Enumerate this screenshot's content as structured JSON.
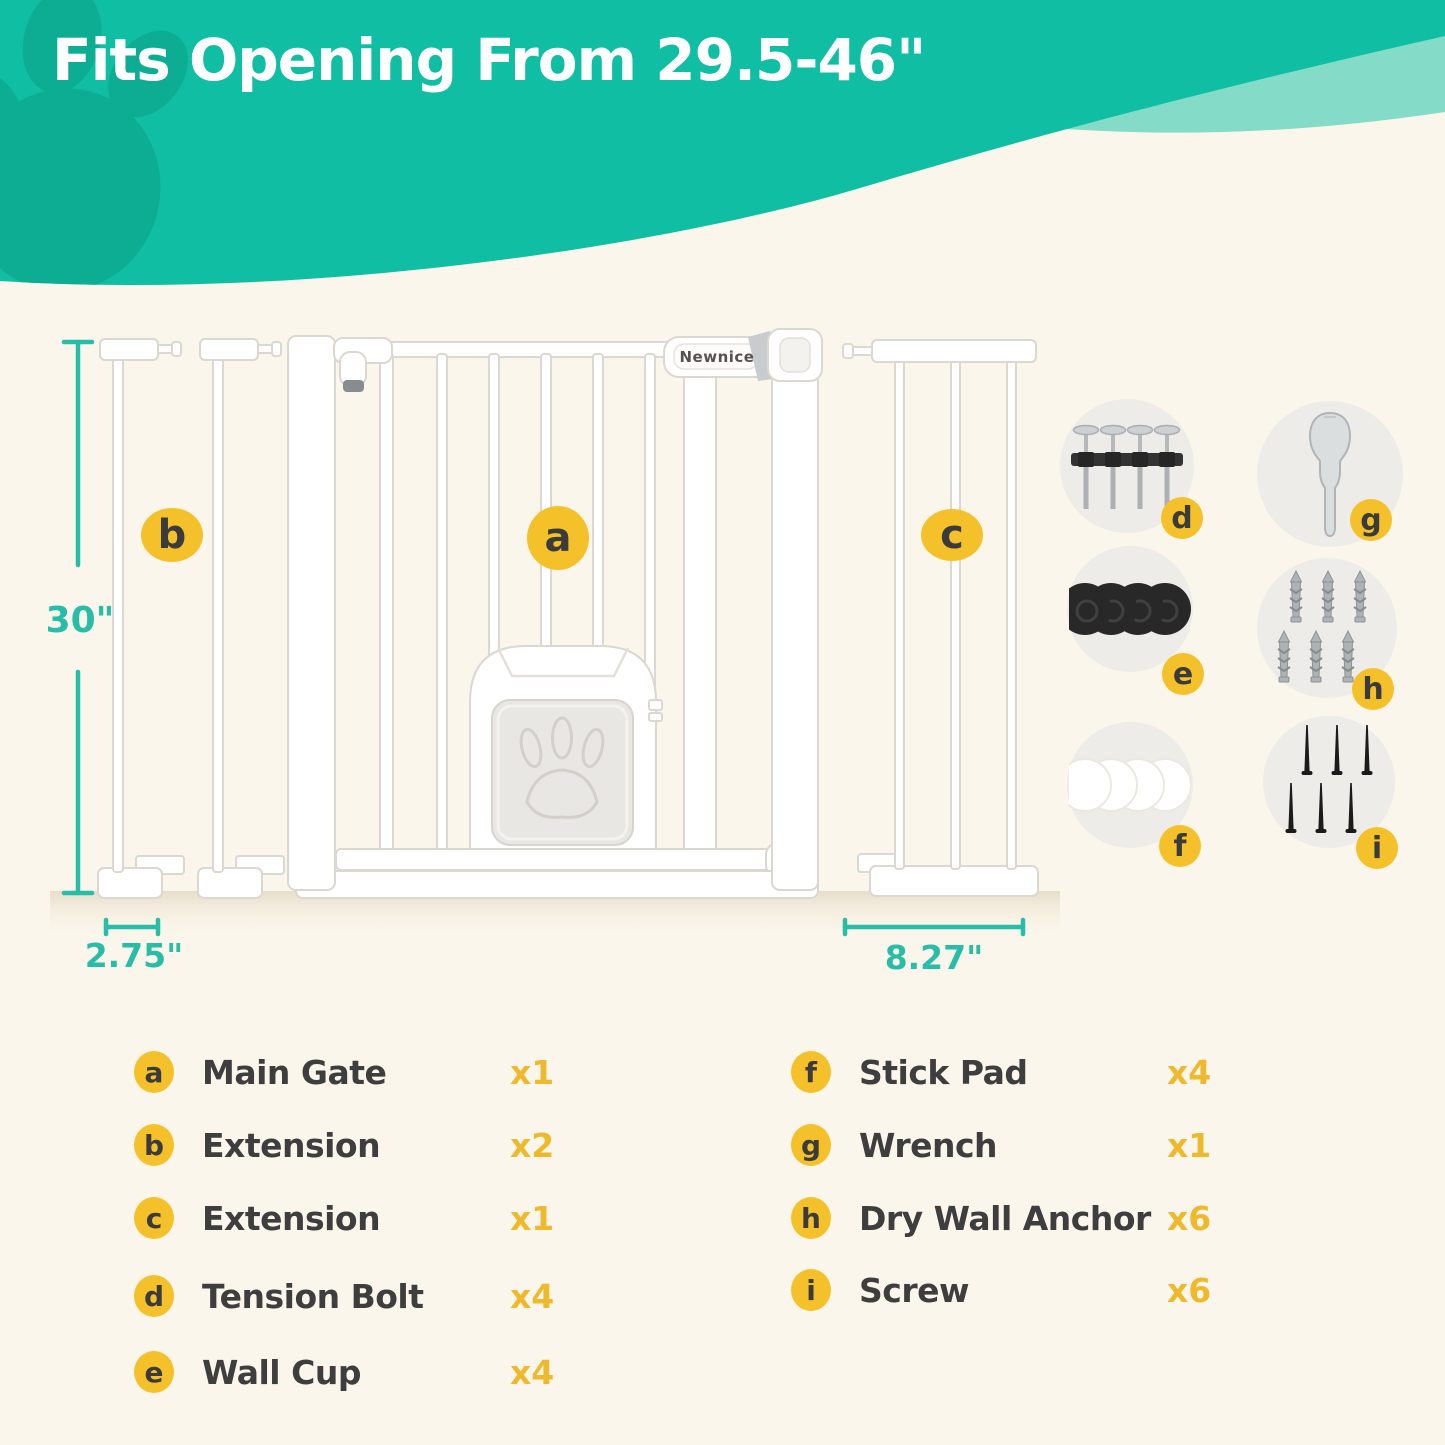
{
  "banner": {
    "headline": "Fits Opening From 29.5-46\""
  },
  "diagram": {
    "brand_label": "Newnice",
    "callouts": {
      "main_gate": "a",
      "extension_small": "b",
      "extension_large": "c"
    },
    "dimensions": {
      "gate_height": "30\"",
      "small_extension_width": "2.75\"",
      "large_extension_width": "8.27\""
    }
  },
  "parts_panel": {
    "items": [
      {
        "id": "tension-bolt",
        "badge": "d"
      },
      {
        "id": "wrench",
        "badge": "g"
      },
      {
        "id": "wall-cup",
        "badge": "e"
      },
      {
        "id": "drywall-anchor",
        "badge": "h"
      },
      {
        "id": "stick-pad",
        "badge": "f"
      },
      {
        "id": "screw",
        "badge": "i"
      }
    ]
  },
  "legend": {
    "left": [
      {
        "badge": "a",
        "label": "Main Gate",
        "qty": "x1"
      },
      {
        "badge": "b",
        "label": "Extension",
        "qty": "x2"
      },
      {
        "badge": "c",
        "label": "Extension",
        "qty": "x1"
      },
      {
        "badge": "d",
        "label": "Tension Bolt",
        "qty": "x4"
      },
      {
        "badge": "e",
        "label": "Wall Cup",
        "qty": "x4"
      }
    ],
    "right": [
      {
        "badge": "f",
        "label": "Stick Pad",
        "qty": "x4"
      },
      {
        "badge": "g",
        "label": "Wrench",
        "qty": "x1"
      },
      {
        "badge": "h",
        "label": "Dry Wall Anchor",
        "qty": "x6"
      },
      {
        "badge": "i",
        "label": "Screw",
        "qty": "x6"
      }
    ]
  },
  "colors": {
    "teal": "#0FBEA3",
    "teal_light_band": "#84DCC8",
    "paw_teal": "#0CAD92",
    "cream_background": "#FBF6EB",
    "accent_yellow": "#F5C12B",
    "qty_yellow": "#EFB92E",
    "dimension_teal": "#27BDA7",
    "text_dark": "#3E3E3E"
  }
}
